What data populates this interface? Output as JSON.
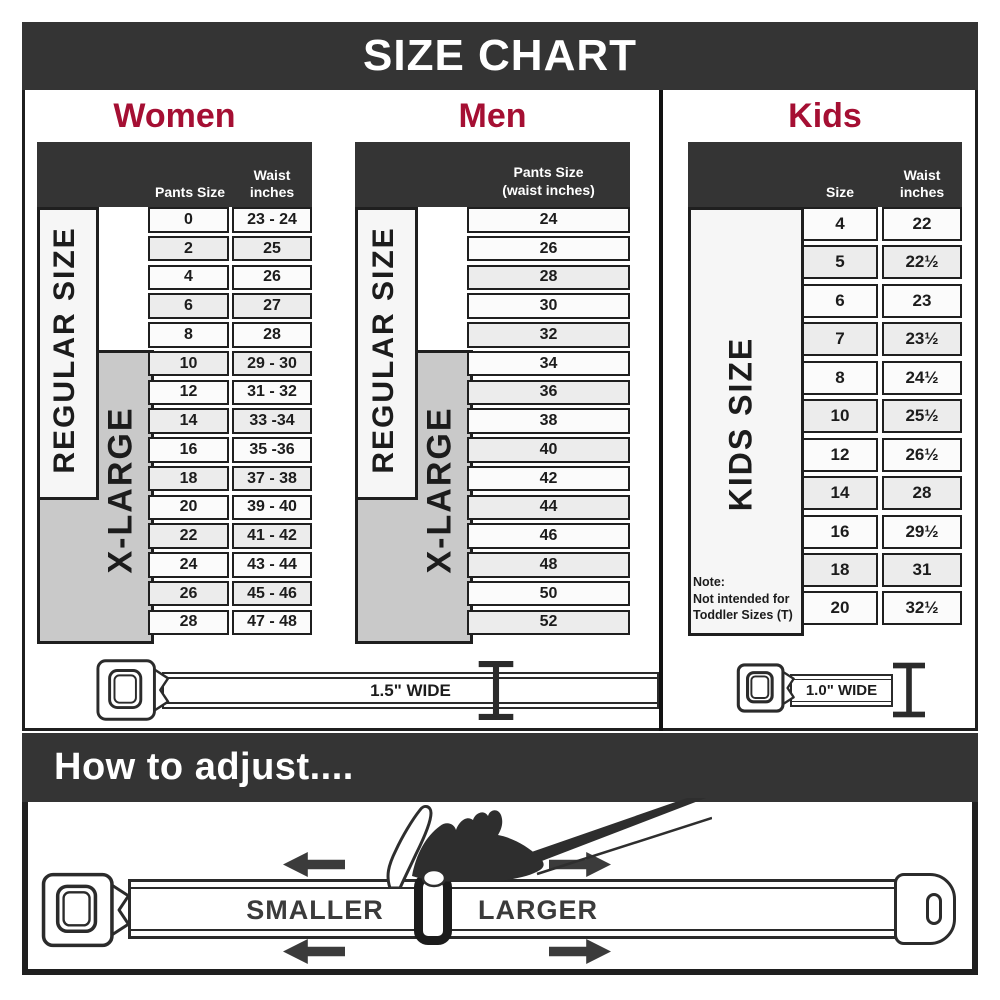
{
  "header": {
    "title": "SIZE CHART"
  },
  "women": {
    "title": "Women",
    "header_col1": "Pants Size",
    "header_col2": "Waist\ninches",
    "band_regular": "REGULAR SIZE",
    "band_xlarge": "X-LARGE",
    "rows": [
      [
        "0",
        "23 - 24"
      ],
      [
        "2",
        "25"
      ],
      [
        "4",
        "26"
      ],
      [
        "6",
        "27"
      ],
      [
        "8",
        "28"
      ],
      [
        "10",
        "29 - 30"
      ],
      [
        "12",
        "31 - 32"
      ],
      [
        "14",
        "33 -34"
      ],
      [
        "16",
        "35 -36"
      ],
      [
        "18",
        "37 - 38"
      ],
      [
        "20",
        "39 - 40"
      ],
      [
        "22",
        "41 - 42"
      ],
      [
        "24",
        "43 - 44"
      ],
      [
        "26",
        "45 - 46"
      ],
      [
        "28",
        "47 - 48"
      ]
    ]
  },
  "men": {
    "title": "Men",
    "header_col": "Pants Size\n(waist inches)",
    "band_regular": "REGULAR SIZE",
    "band_xlarge": "X-LARGE",
    "rows": [
      [
        "24"
      ],
      [
        "26"
      ],
      [
        "28"
      ],
      [
        "30"
      ],
      [
        "32"
      ],
      [
        "34"
      ],
      [
        "36"
      ],
      [
        "38"
      ],
      [
        "40"
      ],
      [
        "42"
      ],
      [
        "44"
      ],
      [
        "46"
      ],
      [
        "48"
      ],
      [
        "50"
      ],
      [
        "52"
      ]
    ]
  },
  "kids": {
    "title": "Kids",
    "header_col1": "Size",
    "header_col2": "Waist\ninches",
    "band": "KIDS SIZE",
    "note": "Note:\nNot intended for\nToddler Sizes (T)",
    "rows": [
      [
        "4",
        "22"
      ],
      [
        "5",
        "22½"
      ],
      [
        "6",
        "23"
      ],
      [
        "7",
        "23½"
      ],
      [
        "8",
        "24½"
      ],
      [
        "10",
        "25½"
      ],
      [
        "12",
        "26½"
      ],
      [
        "14",
        "28"
      ],
      [
        "16",
        "29½"
      ],
      [
        "18",
        "31"
      ],
      [
        "20",
        "32½"
      ]
    ]
  },
  "belts": {
    "adult_label": "1.5\" WIDE",
    "kids_label": "1.0\" WIDE"
  },
  "adjust": {
    "title": "How to adjust....",
    "smaller": "SMALLER",
    "larger": "LARGER"
  },
  "colors": {
    "charcoal": "#343434",
    "crimson": "#a50f33",
    "band_gray": "#c9c9c9",
    "row_light": "#fbfbfb",
    "row_shaded": "#ececec",
    "line": "#2b2b2b",
    "bottom_text": "#3b3b3b"
  }
}
